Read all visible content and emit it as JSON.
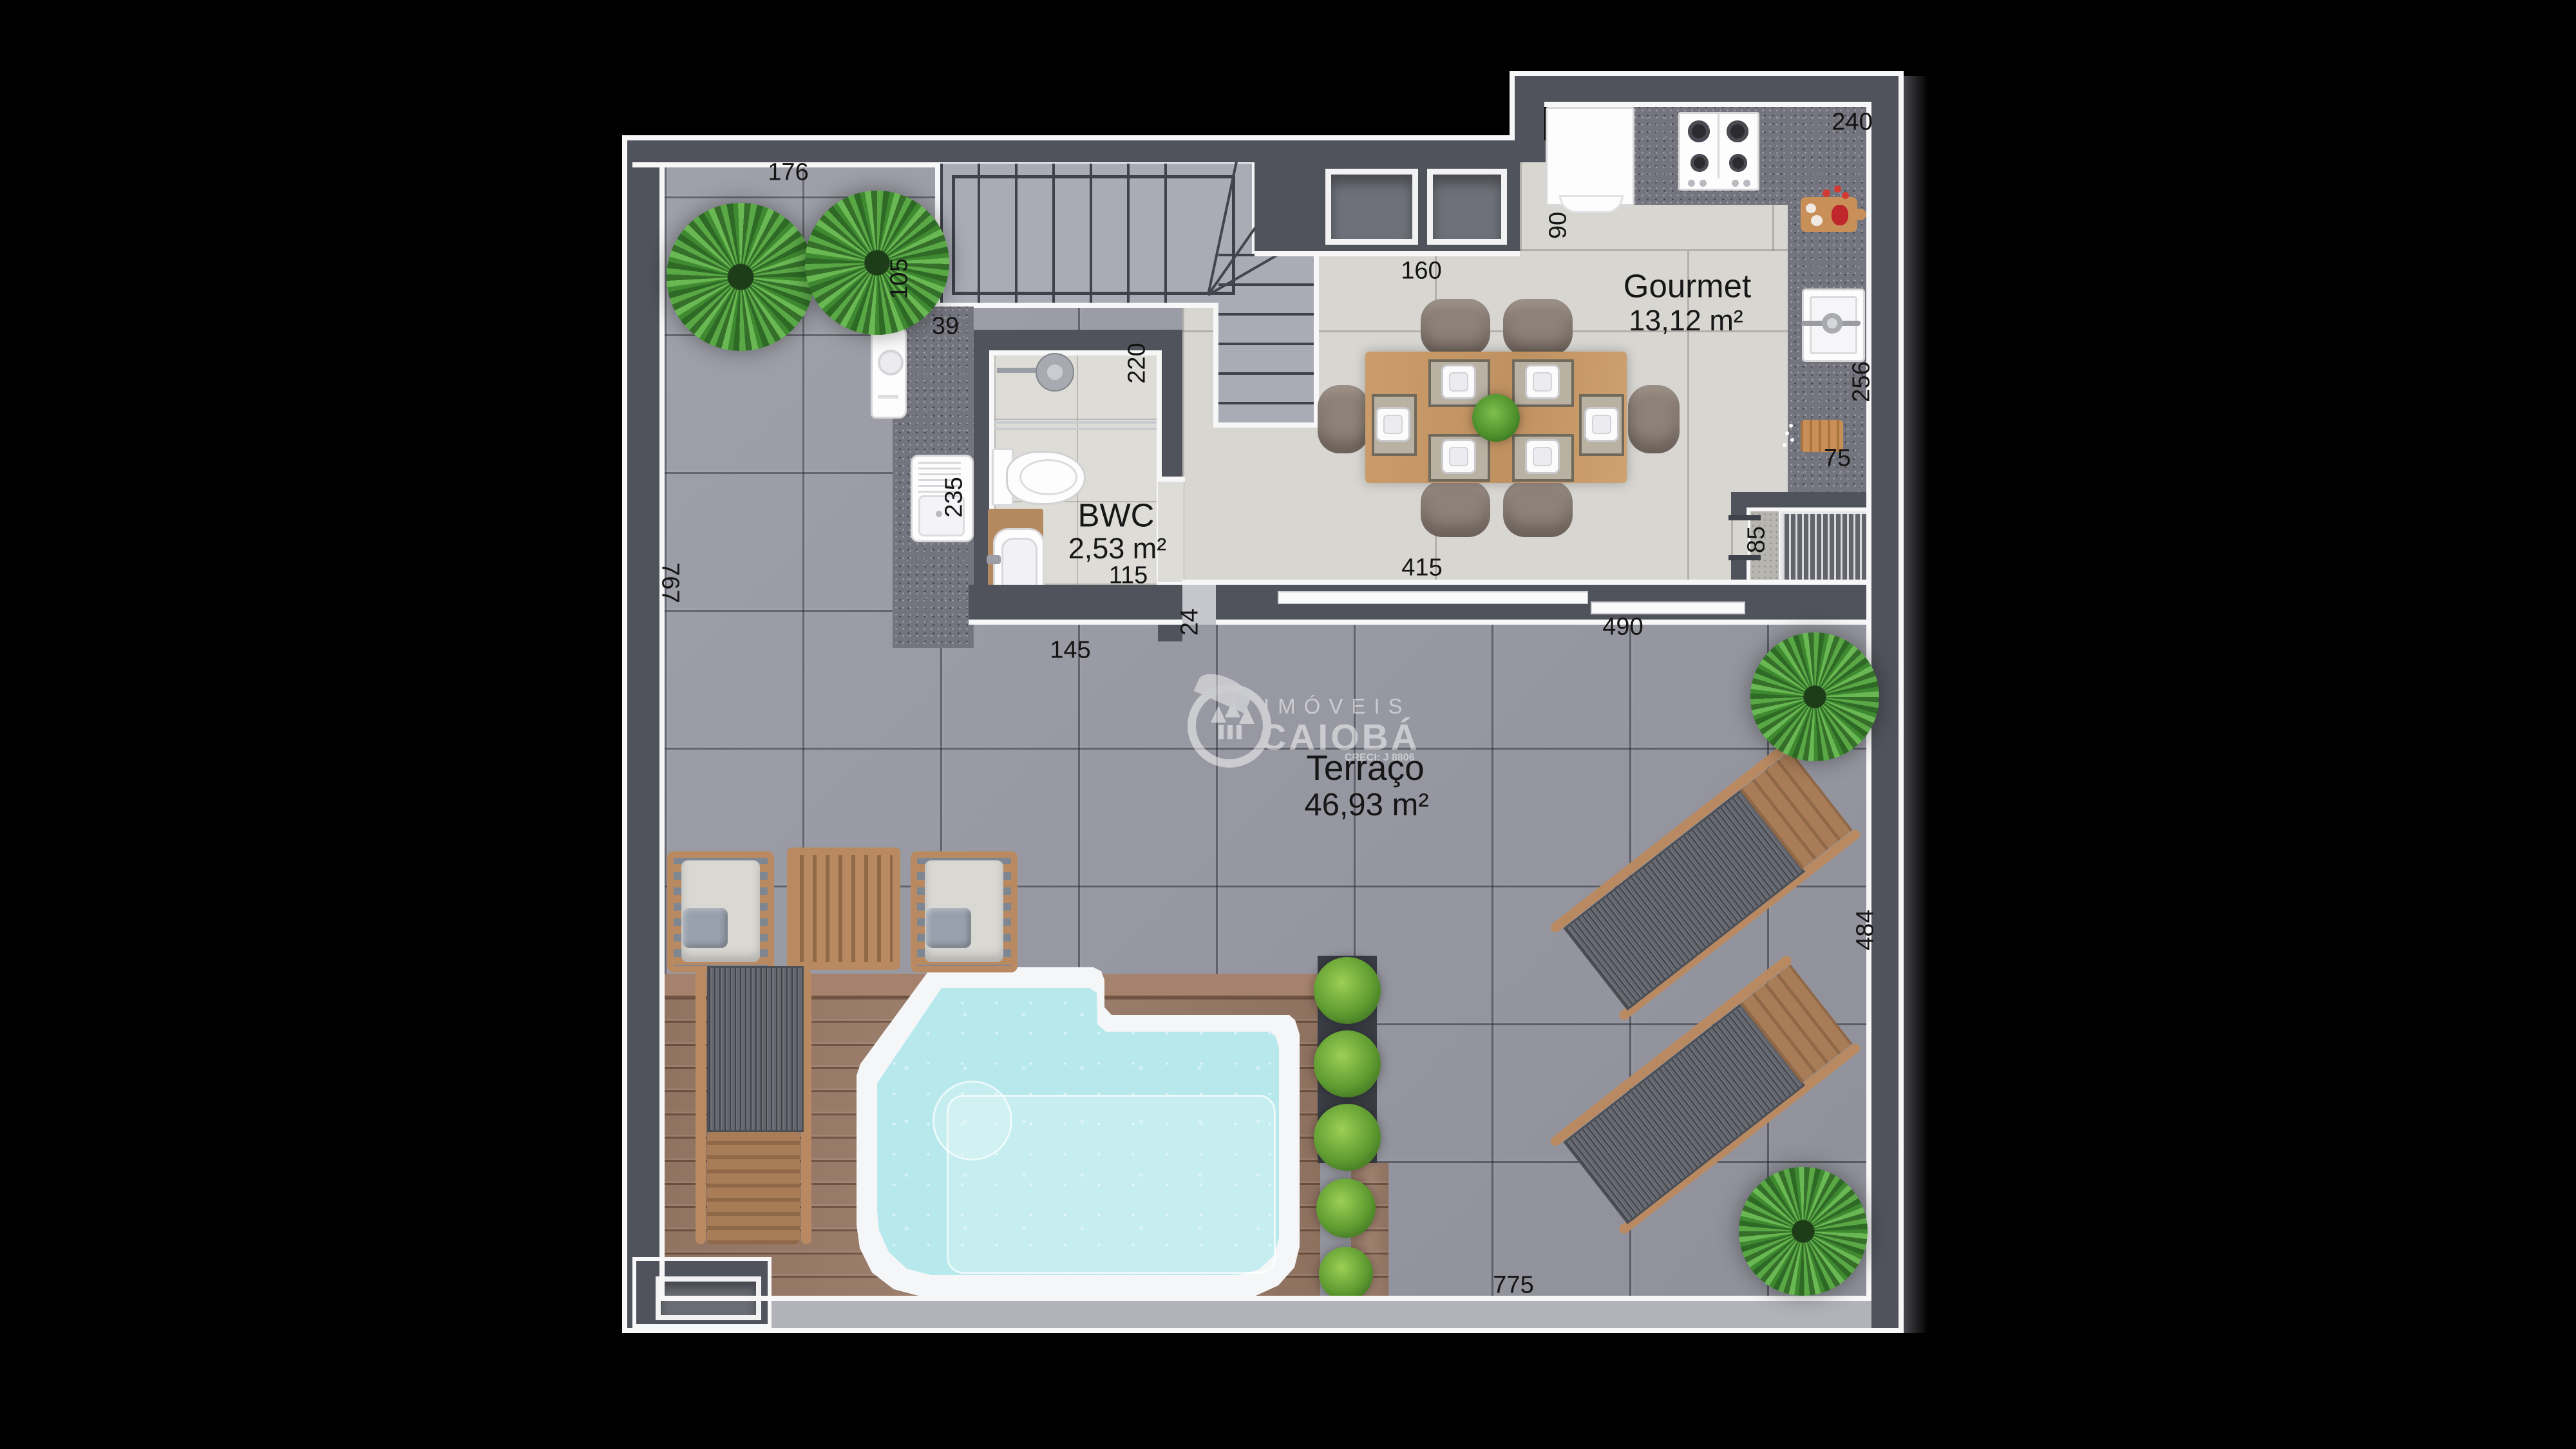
{
  "rooms": {
    "gourmet": {
      "name": "Gourmet",
      "area": "13,12 m²"
    },
    "bwc": {
      "name": "BWC",
      "area": "2,53 m²"
    },
    "terraco": {
      "name": "Terraço",
      "area": "46,93 m²"
    }
  },
  "dimensions": {
    "d176": "176",
    "d105": "105",
    "d39": "39",
    "d220": "220",
    "d235": "235",
    "d115": "115",
    "d24": "24",
    "d145": "145",
    "d767": "767",
    "d160": "160",
    "d90": "90",
    "d240": "240",
    "d256": "256",
    "d75": "75",
    "d85": "85",
    "d415": "415",
    "d490": "490",
    "d484": "484",
    "d775": "775"
  },
  "watermark": {
    "brand_top": "IMÓVEIS",
    "brand": "CAIOBÁ",
    "creci": "CRECI: J 8806"
  },
  "colors": {
    "background": "#000000",
    "wall": "#51535c",
    "wall_bottom": "#b2b3ba",
    "lining": "#f7f7f8",
    "terrace_tile": "#9a9ba5",
    "gourmet_floor": "#d8d6d1",
    "granite_counter": "#74747e",
    "deck_wood": "#9a7a67",
    "furniture_wood": "#b98a62",
    "pool_water": "#b7e9ec",
    "pool_coping": "#f4f6f7",
    "plant_green": "#4c923c",
    "dimension_text": "#141414"
  }
}
